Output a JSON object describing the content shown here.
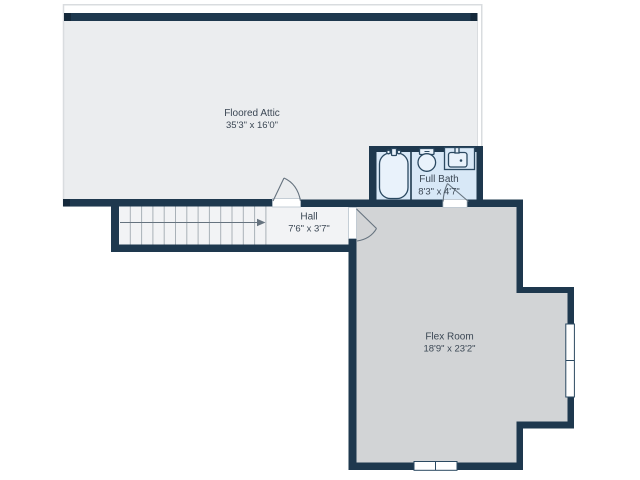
{
  "plan_type": "floor-plan",
  "rooms": [
    {
      "name": "Floored Attic",
      "dims": "35'3\" x 16'0\""
    },
    {
      "name": "Full Bath",
      "dims": "8'3\" x 4'7\""
    },
    {
      "name": "Hall",
      "dims": "7'6\" x 3'7\""
    },
    {
      "name": "Flex Room",
      "dims": "18'9\" x 23'2\""
    }
  ],
  "icons": [
    "bathtub-icon",
    "toilet-icon",
    "sink-icon",
    "stairs-up-arrow-icon",
    "window-icon",
    "door-swing-icon"
  ],
  "colors": {
    "wall": "#1e384e",
    "wall_cap": "#15293b",
    "attic_floor": "#ebedef",
    "hall_floor": "#f2f3f5",
    "flex_floor": "#d2d4d6",
    "bath_floor": "#d8e8f7",
    "fixture_fill": "#e9f2fb",
    "fixture_stroke": "#2b4961",
    "text": "#3b4754",
    "roofline": "#d9dcdf",
    "tread": "#a9b1b8",
    "swing": "#66737f",
    "threshold": "#b8c3cd",
    "background": "#ffffff"
  }
}
